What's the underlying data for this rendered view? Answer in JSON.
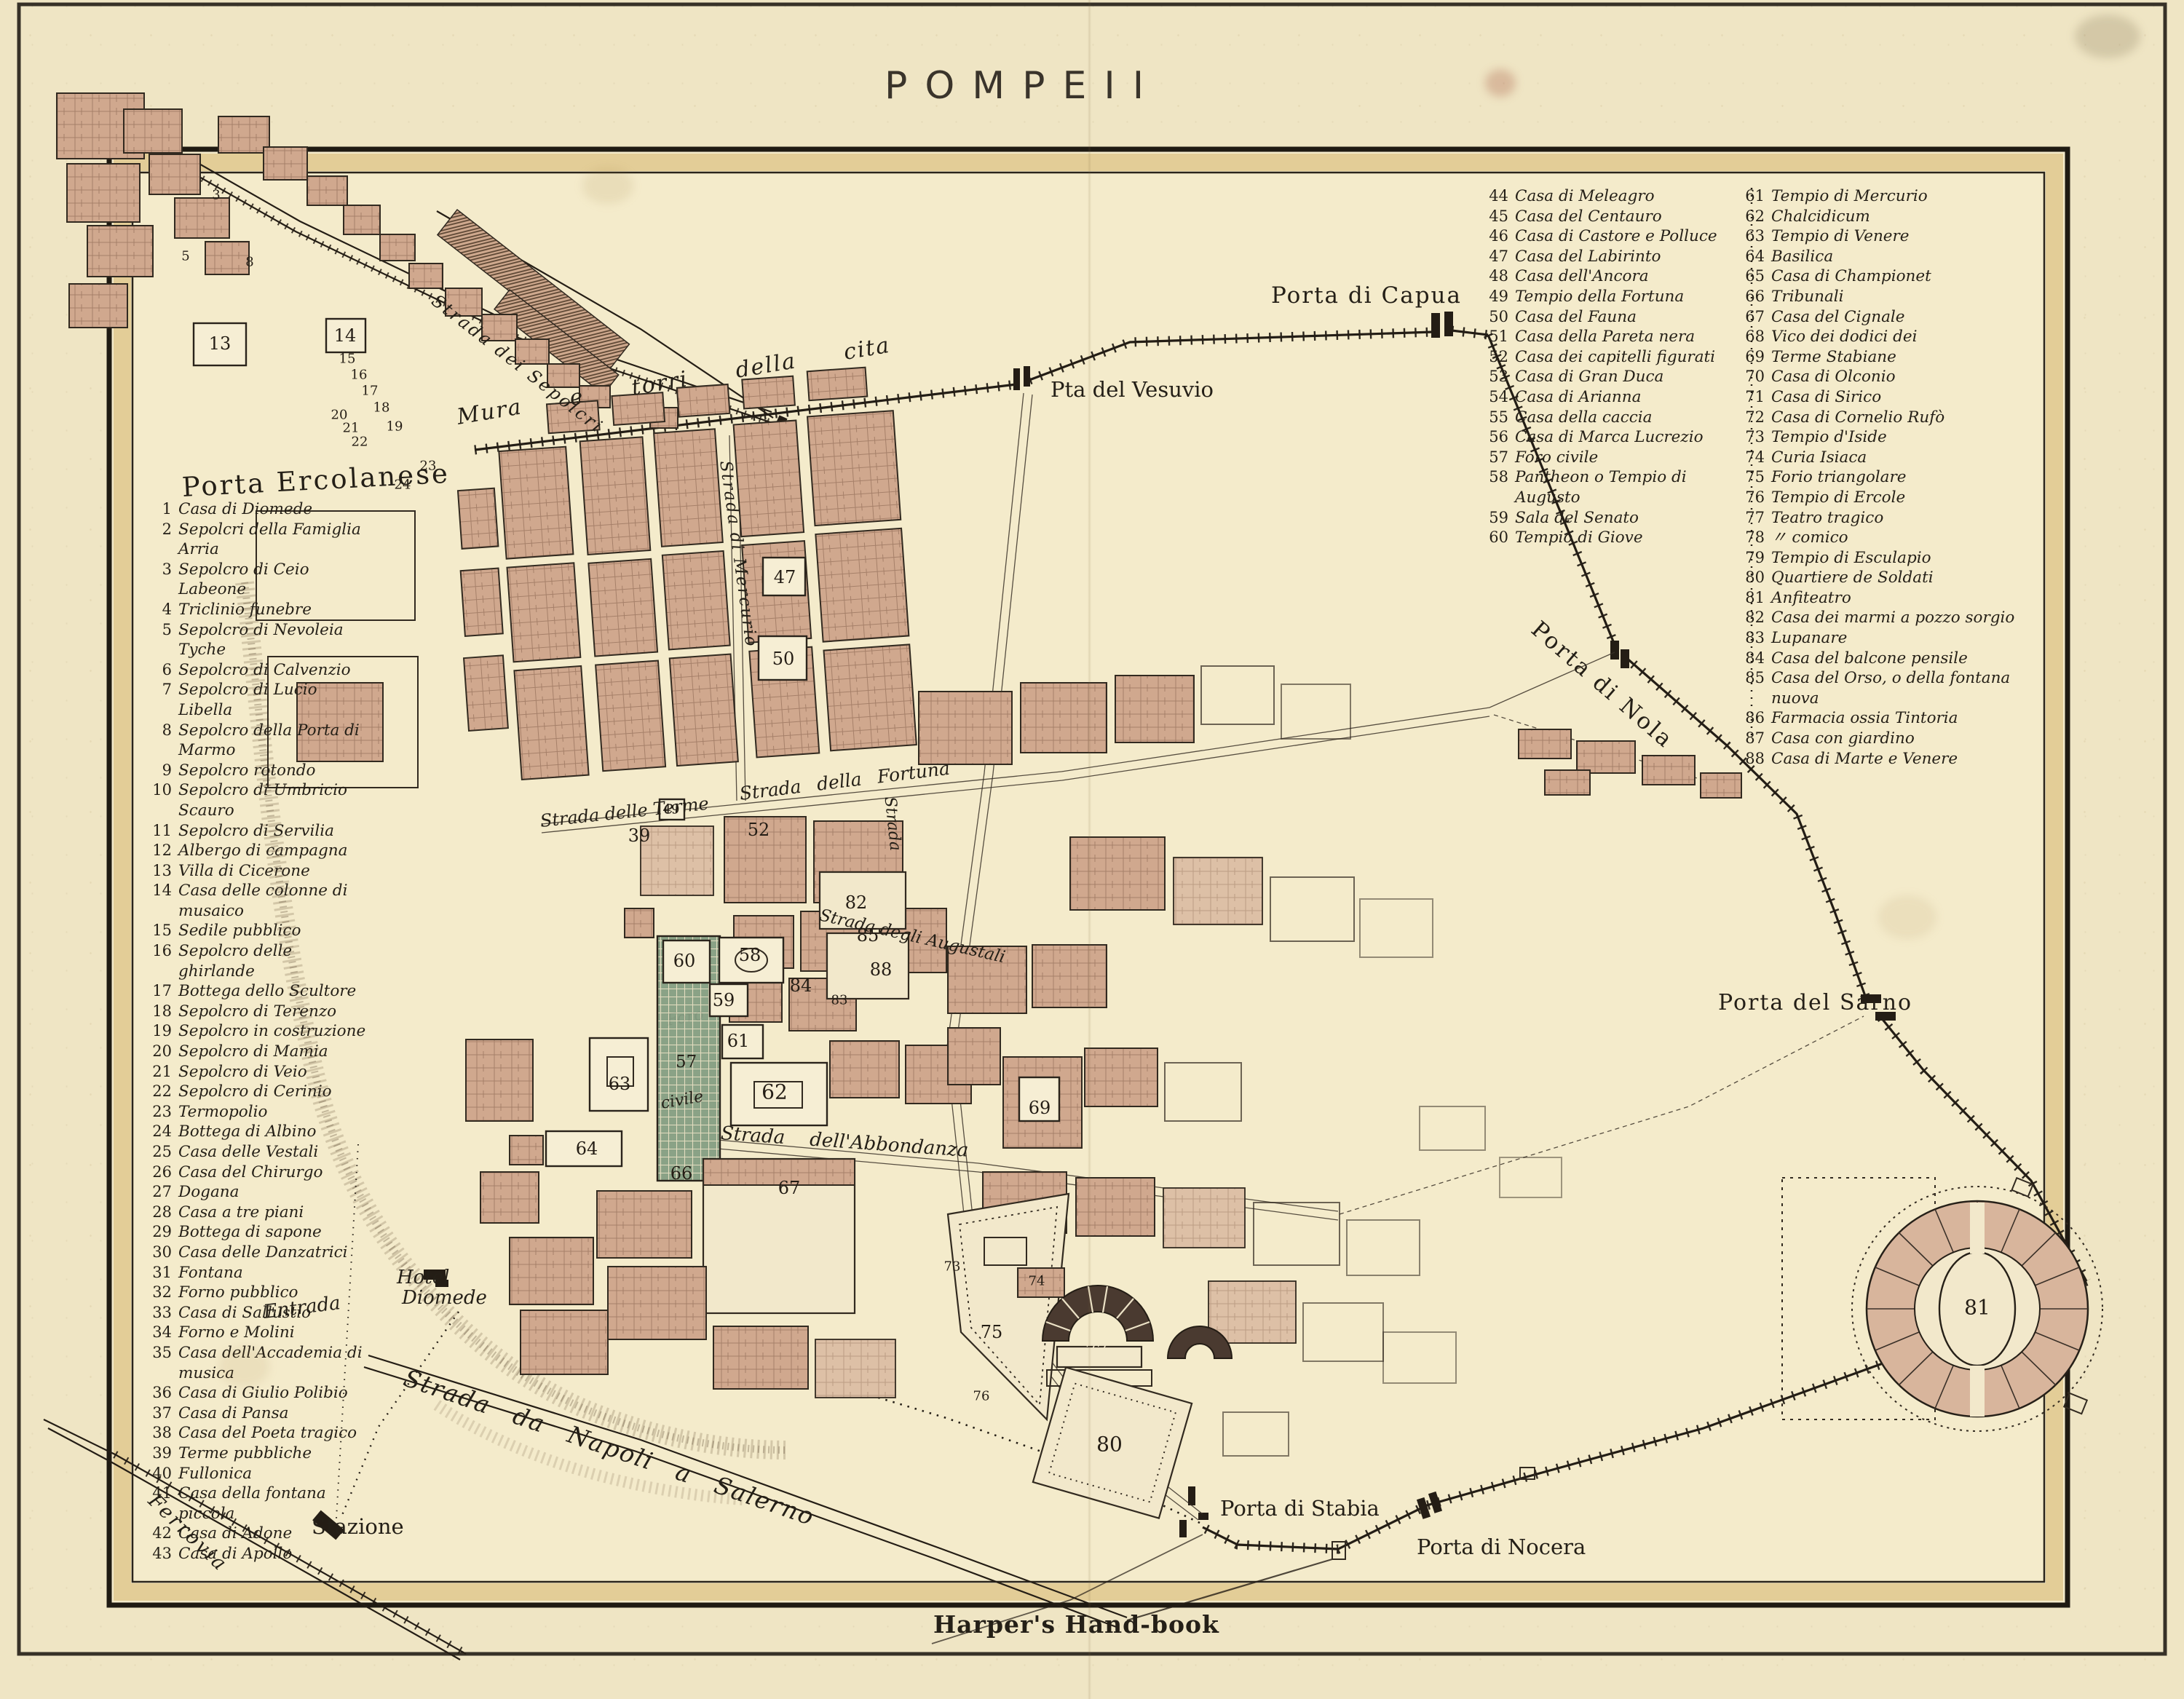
{
  "title": "POMPEII",
  "credit": "Harper's Hand-book",
  "legend": {
    "left": [
      {
        "n": "1",
        "t": "Casa di Diomede"
      },
      {
        "n": "2",
        "t": "Sepolcri della Famiglia Arria"
      },
      {
        "n": "3",
        "t": "Sepolcro di Ceio Labeone"
      },
      {
        "n": "4",
        "t": "Triclinio funebre"
      },
      {
        "n": "5",
        "t": "Sepolcro di Nevoleia Tyche"
      },
      {
        "n": "6",
        "t": "Sepolcro di Calvenzio"
      },
      {
        "n": "7",
        "t": "Sepolcro di Lucio Libella"
      },
      {
        "n": "8",
        "t": "Sepolcro della Porta di Marmo"
      },
      {
        "n": "9",
        "t": "Sepolcro rotondo"
      },
      {
        "n": "10",
        "t": "Sepolcro di Umbricio Scauro"
      },
      {
        "n": "11",
        "t": "Sepolcro di Servilia"
      },
      {
        "n": "12",
        "t": "Albergo di campagna"
      },
      {
        "n": "13",
        "t": "Villa di Cicerone"
      },
      {
        "n": "14",
        "t": "Casa delle colonne di musaico"
      },
      {
        "n": "15",
        "t": "Sedile pubblico"
      },
      {
        "n": "16",
        "t": "Sepolcro delle ghirlande"
      },
      {
        "n": "17",
        "t": "Bottega dello Scultore"
      },
      {
        "n": "18",
        "t": "Sepolcro di Terenzo"
      },
      {
        "n": "19",
        "t": "Sepolcro in costruzione"
      },
      {
        "n": "20",
        "t": "Sepolcro di Mamia"
      },
      {
        "n": "21",
        "t": "Sepolcro di Veio"
      },
      {
        "n": "22",
        "t": "Sepolcro di Cerinio"
      },
      {
        "n": "23",
        "t": "Termopolio"
      },
      {
        "n": "24",
        "t": "Bottega di Albino"
      },
      {
        "n": "25",
        "t": "Casa delle Vestali"
      },
      {
        "n": "26",
        "t": "Casa del Chirurgo"
      },
      {
        "n": "27",
        "t": "Dogana"
      },
      {
        "n": "28",
        "t": "Casa a tre piani"
      },
      {
        "n": "29",
        "t": "Bottega di sapone"
      },
      {
        "n": "30",
        "t": "Casa delle Danzatrici"
      },
      {
        "n": "31",
        "t": "Fontana"
      },
      {
        "n": "32",
        "t": "Forno pubblico"
      },
      {
        "n": "33",
        "t": "Casa di Sallustio"
      },
      {
        "n": "34",
        "t": "Forno e Molini"
      },
      {
        "n": "35",
        "t": "Casa dell'Accademia di musica"
      },
      {
        "n": "36",
        "t": "Casa di Giulio Polibio"
      },
      {
        "n": "37",
        "t": "Casa di Pansa"
      },
      {
        "n": "38",
        "t": "Casa del Poeta tragico"
      },
      {
        "n": "39",
        "t": "Terme pubbliche"
      },
      {
        "n": "40",
        "t": "Fullonica"
      },
      {
        "n": "41",
        "t": "Casa della fontana piccola"
      },
      {
        "n": "42",
        "t": "Casa di Adone"
      },
      {
        "n": "43",
        "t": "Casa di Apollo"
      }
    ],
    "middle": [
      {
        "n": "44",
        "t": "Casa di Meleagro"
      },
      {
        "n": "45",
        "t": "Casa del Centauro"
      },
      {
        "n": "46",
        "t": "Casa di Castore e Polluce"
      },
      {
        "n": "47",
        "t": "Casa del Labirinto"
      },
      {
        "n": "48",
        "t": "Casa dell'Ancora"
      },
      {
        "n": "49",
        "t": "Tempio della Fortuna"
      },
      {
        "n": "50",
        "t": "Casa del Fauna"
      },
      {
        "n": "51",
        "t": "Casa della Pareta nera"
      },
      {
        "n": "52",
        "t": "Casa dei capitelli figurati"
      },
      {
        "n": "53",
        "t": "Casa di Gran Duca"
      },
      {
        "n": "54",
        "t": "Casa di Arianna"
      },
      {
        "n": "55",
        "t": "Casa della caccia"
      },
      {
        "n": "56",
        "t": "Casa di Marca Lucrezio"
      },
      {
        "n": "57",
        "t": "Foro civile"
      },
      {
        "n": "58",
        "t": "Pantheon o Tempio di Augusto"
      },
      {
        "n": "59",
        "t": "Sala del Senato"
      },
      {
        "n": "60",
        "t": "Tempio di Giove"
      }
    ],
    "right": [
      {
        "n": "61",
        "t": "Tempio di Mercurio"
      },
      {
        "n": "62",
        "t": "Chalcidicum"
      },
      {
        "n": "63",
        "t": "Tempio di Venere"
      },
      {
        "n": "64",
        "t": "Basilica"
      },
      {
        "n": "65",
        "t": "Casa di Championet"
      },
      {
        "n": "66",
        "t": "Tribunali"
      },
      {
        "n": "67",
        "t": "Casa del Cignale"
      },
      {
        "n": "68",
        "t": "Vico dei dodici dei"
      },
      {
        "n": "69",
        "t": "Terme Stabiane"
      },
      {
        "n": "70",
        "t": "Casa di Olconio"
      },
      {
        "n": "71",
        "t": "Casa di Sirico"
      },
      {
        "n": "72",
        "t": "Casa di Cornelio Rufò"
      },
      {
        "n": "73",
        "t": "Tempio d'Iside"
      },
      {
        "n": "74",
        "t": "Curia Isiaca"
      },
      {
        "n": "75",
        "t": "Forio triangolare"
      },
      {
        "n": "76",
        "t": "Tempio di Ercole"
      },
      {
        "n": "77",
        "t": "Teatro tragico"
      },
      {
        "n": "78",
        "t": "〃        comico"
      },
      {
        "n": "79",
        "t": "Tempio di Esculapio"
      },
      {
        "n": "80",
        "t": "Quartiere de Soldati"
      },
      {
        "n": "81",
        "t": "Anfiteatro"
      },
      {
        "n": "82",
        "t": "Casa dei marmi a pozzo sorgio"
      },
      {
        "n": "83",
        "t": "Lupanare"
      },
      {
        "n": "84",
        "t": "Casa del balcone pensile"
      },
      {
        "n": "85",
        "t": "Casa del Orso, o della fontana nuova"
      },
      {
        "n": "86",
        "t": "Farmacia ossia Tintoria"
      },
      {
        "n": "87",
        "t": "Casa con giardino"
      },
      {
        "n": "88",
        "t": "Casa di Marte e Venere"
      }
    ]
  },
  "map": {
    "walls_label": "Mura e torri della cita",
    "gates": {
      "ercolanese": "Porta Ercolanese",
      "vesuvio": "Pta del Vesuvio",
      "capua": "Porta di Capua",
      "nola": "Porta di Nola",
      "sarno": "Porta del Sarno",
      "stabia": "Porta di Stabia",
      "nocera": "Porta di Nocera"
    },
    "streets": {
      "sepolcri": "Strada dei Sepolcri",
      "terme": "Strada delle Terme",
      "fortuna": "Strada della Fortuna",
      "mercurio": "Strada di Mercurio",
      "augustali": "Strada degli Augustali",
      "abbondanza": "Strada dell'Abbondanza",
      "strada": "Strada",
      "napoli": "Strada da Napoli a Salerno"
    },
    "railway": {
      "ferrovia": "Ferrovia",
      "stazione": "Stazione"
    },
    "hotel": {
      "l1": "Hotel",
      "l2": "Diomede",
      "l3": "Entrada"
    },
    "forum": {
      "l1": "Foro",
      "n": "57",
      "l2": "civile"
    },
    "numbers": {
      "n3": "3",
      "n5": "5",
      "n8": "8",
      "n13": "13",
      "n14": "14",
      "n15": "15",
      "n16": "16",
      "n17": "17",
      "n18": "18",
      "n19": "19",
      "n20": "20",
      "n21": "21",
      "n22": "22",
      "n23": "23",
      "n24": "24",
      "n39": "39",
      "n47": "47",
      "n49": "49",
      "n50": "50",
      "n52": "52",
      "n58": "58",
      "n59": "59",
      "n60": "60",
      "n61": "61",
      "n62": "62",
      "n63": "63",
      "n64": "64",
      "n66": "66",
      "n67": "67",
      "n69": "69",
      "n73": "73",
      "n74": "74",
      "n75": "75",
      "n76": "76",
      "n77": "77",
      "n80": "80",
      "n81": "81",
      "n82": "82",
      "n83": "83",
      "n84": "84",
      "n85": "85",
      "n88": "88"
    }
  }
}
